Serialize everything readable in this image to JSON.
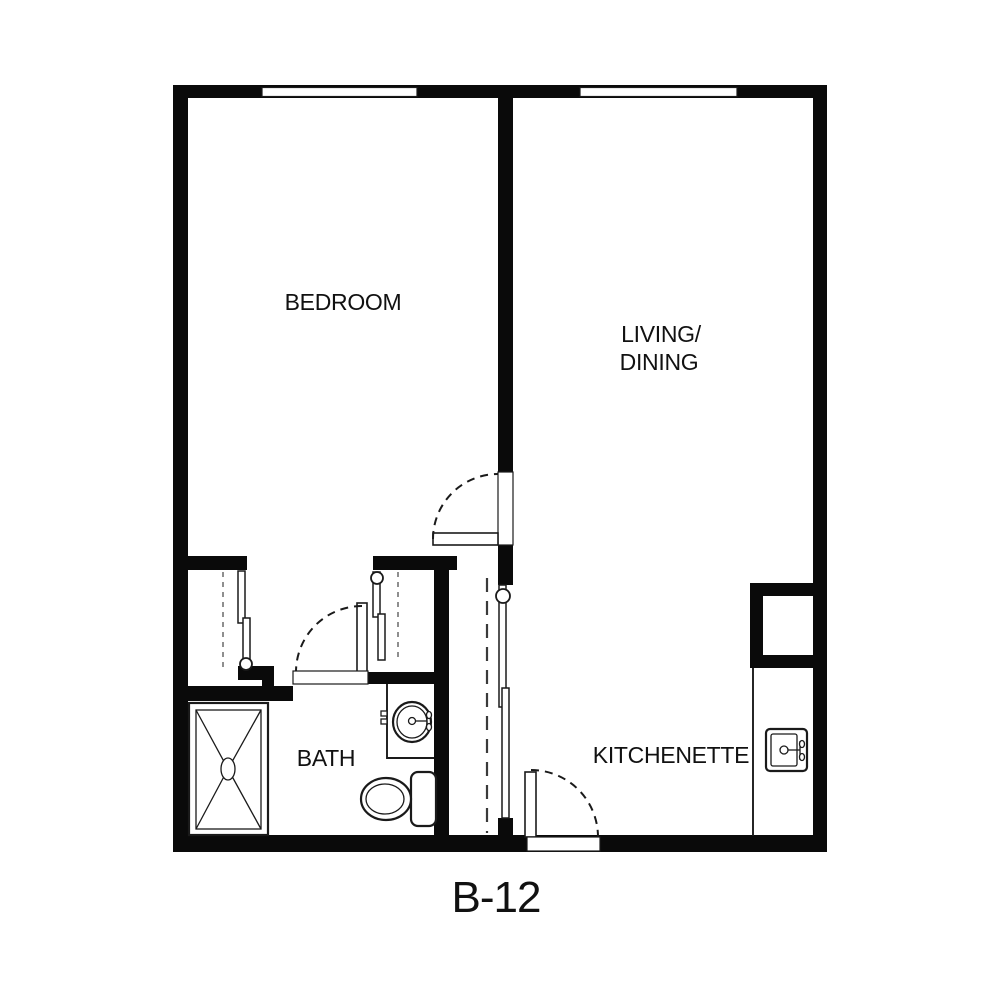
{
  "plan": {
    "title": "B-12",
    "rooms": {
      "bedroom": {
        "label": "BEDROOM"
      },
      "living_dining": {
        "label_line1": "LIVING/",
        "label_line2": "DINING"
      },
      "bath": {
        "label": "BATH"
      },
      "kitchenette": {
        "label": "KITCHENETTE"
      }
    },
    "colors": {
      "walls": "#0a0a0a",
      "background": "#ffffff",
      "fixture_lines": "#1a1a1a",
      "closet_rod_dash": "#8f8f8f"
    },
    "fixtures": {
      "shower": "shower-with-x-pattern",
      "bath_sink": "oval-lavatory-sink",
      "toilet": "toilet-with-tank",
      "kitchen_sink": "kitchen-sink-with-faucet",
      "closets": "sliding-door-closets-with-rods",
      "doors": "hinged-doors-with-swing-arcs"
    }
  }
}
